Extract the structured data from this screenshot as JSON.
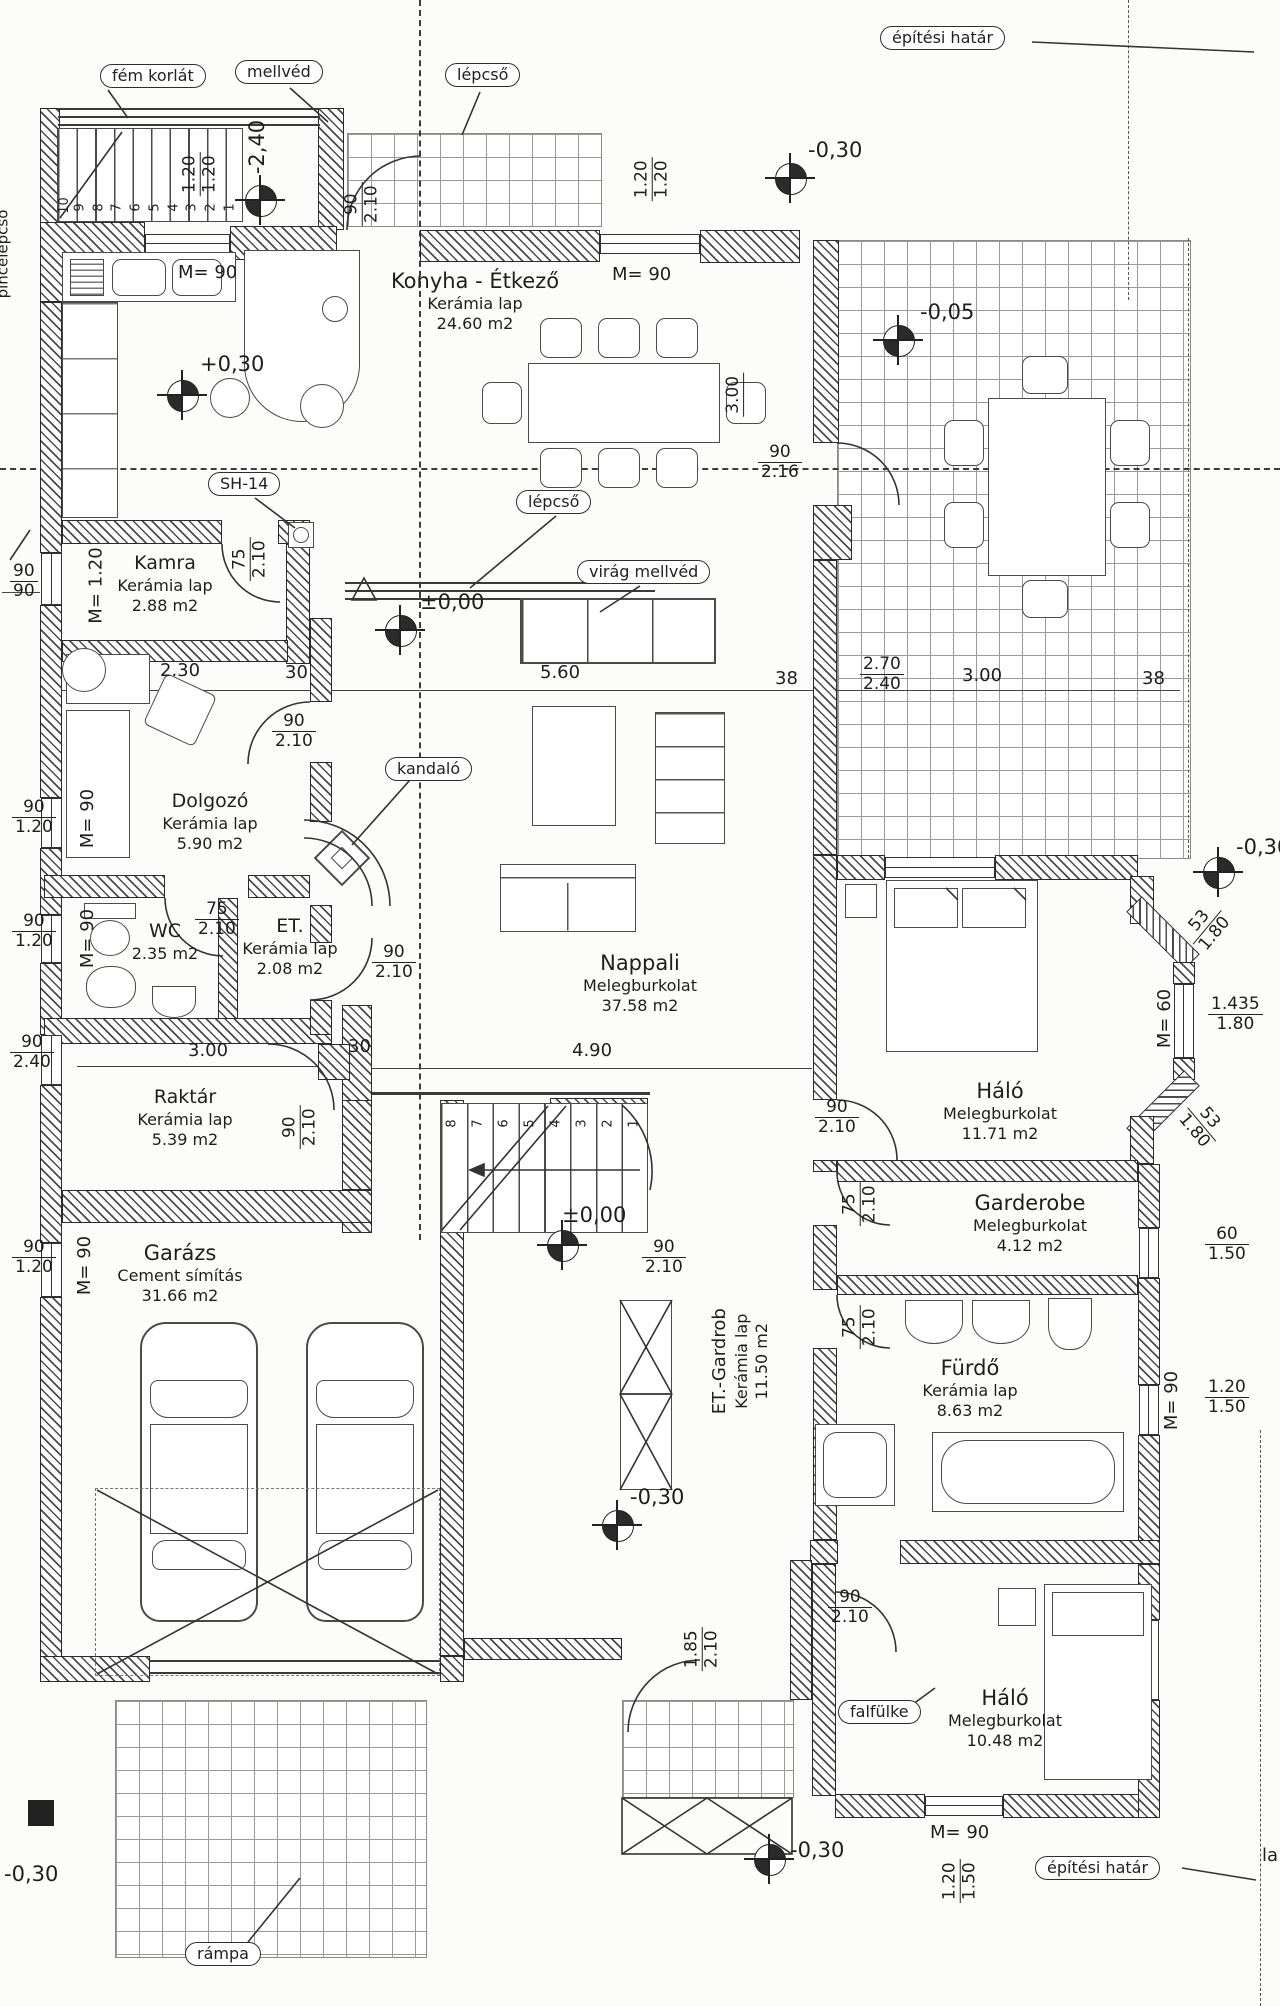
{
  "callouts": {
    "fem_korlat": "fém korlát",
    "mellved": "mellvéd",
    "lepcso_top": "lépcső",
    "epitesi_hatar": "építési határ",
    "pincelepcso": "pincelépcső",
    "sh14": "SH-14",
    "lepcso_mid": "lépcső",
    "virag_mellved": "virág mellvéd",
    "kandalo": "kandaló",
    "falfulke": "falfülke",
    "rampa": "rámpa",
    "la": "la"
  },
  "rooms": {
    "konyha": {
      "name": "Konyha - Étkező",
      "finish": "Kerámia lap",
      "area": "24.60 m2"
    },
    "kamra": {
      "name": "Kamra",
      "finish": "Kerámia lap",
      "area": "2.88 m2"
    },
    "dolgozo": {
      "name": "Dolgozó",
      "finish": "Kerámia lap",
      "area": "5.90 m2"
    },
    "wc": {
      "name": "WC",
      "area": "2.35 m2"
    },
    "et": {
      "name": "ET.",
      "finish": "Kerámia lap",
      "area": "2.08 m2"
    },
    "nappali": {
      "name": "Nappali",
      "finish": "Melegburkolat",
      "area": "37.58 m2"
    },
    "raktar": {
      "name": "Raktár",
      "finish": "Kerámia lap",
      "area": "5.39 m2"
    },
    "garazs": {
      "name": "Garázs",
      "finish": "Cement símítás",
      "area": "31.66 m2"
    },
    "halo1": {
      "name": "Háló",
      "finish": "Melegburkolat",
      "area": "11.71 m2"
    },
    "garderobe": {
      "name": "Garderobe",
      "finish": "Melegburkolat",
      "area": "4.12 m2"
    },
    "furdo": {
      "name": "Fürdő",
      "finish": "Kerámia lap",
      "area": "8.63 m2"
    },
    "etgardrob": {
      "name": "ET.-Gardrob",
      "finish": "Kerámia lap",
      "area": "11.50 m2"
    },
    "halo2": {
      "name": "Háló",
      "finish": "Melegburkolat",
      "area": "10.48 m2"
    }
  },
  "levels": {
    "minus240": "-2,40",
    "minus030": "-0,30",
    "plus030": "+0,30",
    "minus005": "-0,05",
    "zero": "±0,00"
  },
  "dims": {
    "v90": "90",
    "v210": "2.10",
    "v216": "2.16",
    "v75": "75",
    "v120": "1.20",
    "v150": "1.50",
    "v240": "2.40",
    "v230": "2.30",
    "v30": "30",
    "v560": "5.60",
    "v38": "38",
    "v270": "2.70",
    "v300": "3.00",
    "v490": "4.90",
    "v53": "53",
    "v180": "1.80",
    "v60": "60",
    "v1435": "1.435",
    "v185": "1.85",
    "m90": "M= 90",
    "m120": "M= 1.20",
    "m60": "M= 60"
  },
  "stairs": {
    "top": [
      "10",
      "9",
      "8",
      "7",
      "6",
      "5",
      "4",
      "3",
      "2",
      "1"
    ],
    "mid": [
      "8",
      "7",
      "6",
      "5",
      "4",
      "3",
      "2",
      "1"
    ]
  }
}
